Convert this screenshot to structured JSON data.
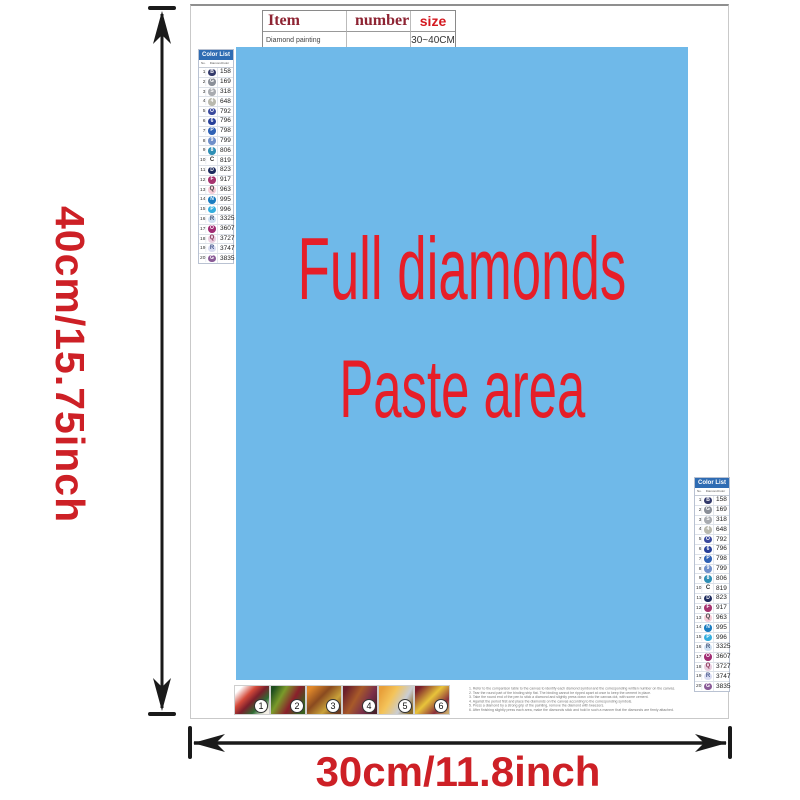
{
  "item_table": {
    "headers": [
      "Item",
      "number",
      "size"
    ],
    "row": [
      "Diamond painting",
      "",
      "30~40CM"
    ]
  },
  "paste_area": {
    "line1": "Full diamonds",
    "line2": "Paste area",
    "bg_color": "#6fb9e9",
    "text_color": "#e61e28"
  },
  "color_list": {
    "title": "Color List",
    "columns": [
      "No.",
      "Diamond",
      "Color"
    ],
    "rows": [
      {
        "no": "1",
        "type": "circle",
        "glyph": "B",
        "bg": "#333a6b",
        "fg": "#ffffff",
        "code": "158"
      },
      {
        "no": "2",
        "type": "circle",
        "glyph": "G",
        "bg": "#8a8f98",
        "fg": "#ffffff",
        "code": "169"
      },
      {
        "no": "3",
        "type": "circle",
        "glyph": "S",
        "bg": "#a8abb0",
        "fg": "#ffffff",
        "code": "318"
      },
      {
        "no": "4",
        "type": "circle",
        "glyph": "4",
        "bg": "#b9b9ae",
        "fg": "#ffffff",
        "code": "648"
      },
      {
        "no": "5",
        "type": "circle",
        "glyph": "O",
        "bg": "#3a4a9e",
        "fg": "#ffffff",
        "code": "792"
      },
      {
        "no": "6",
        "type": "circle",
        "glyph": "6",
        "bg": "#27409a",
        "fg": "#ffffff",
        "code": "796"
      },
      {
        "no": "7",
        "type": "circle",
        "glyph": "P",
        "bg": "#2f62b5",
        "fg": "#ffffff",
        "code": "798"
      },
      {
        "no": "8",
        "type": "circle",
        "glyph": "9",
        "bg": "#6e8fca",
        "fg": "#ffffff",
        "code": "799"
      },
      {
        "no": "9",
        "type": "circle",
        "glyph": "8",
        "bg": "#2e8fb5",
        "fg": "#ffffff",
        "code": "806"
      },
      {
        "no": "10",
        "type": "letter",
        "glyph": "C",
        "bg": "transparent",
        "fg": "#333333",
        "code": "819"
      },
      {
        "no": "11",
        "type": "circle",
        "glyph": "D",
        "bg": "#1d2b5e",
        "fg": "#ffffff",
        "code": "823"
      },
      {
        "no": "12",
        "type": "circle",
        "glyph": "F",
        "bg": "#a6336f",
        "fg": "#ffffff",
        "code": "917"
      },
      {
        "no": "13",
        "type": "letter",
        "glyph": "Q",
        "bg": "#f6cdd8",
        "fg": "#444444",
        "code": "963"
      },
      {
        "no": "14",
        "type": "circle",
        "glyph": "N",
        "bg": "#1a7cc0",
        "fg": "#ffffff",
        "code": "995"
      },
      {
        "no": "15",
        "type": "circle",
        "glyph": "P",
        "bg": "#35aede",
        "fg": "#ffffff",
        "code": "996"
      },
      {
        "no": "16",
        "type": "letter",
        "glyph": "R",
        "bg": "#cfe0f2",
        "fg": "#445577",
        "code": "3325"
      },
      {
        "no": "17",
        "type": "circle",
        "glyph": "O",
        "bg": "#a12d74",
        "fg": "#ffffff",
        "code": "3607"
      },
      {
        "no": "18",
        "type": "letter",
        "glyph": "Q",
        "bg": "#e9cfe0",
        "fg": "#883355",
        "code": "3727"
      },
      {
        "no": "19",
        "type": "letter",
        "glyph": "R",
        "bg": "#d9dcf2",
        "fg": "#445588",
        "code": "3747"
      },
      {
        "no": "20",
        "type": "circle",
        "glyph": "G",
        "bg": "#8a5b97",
        "fg": "#ffffff",
        "code": "3835"
      }
    ]
  },
  "dimensions": {
    "height_label": "40cm/15.75inch",
    "width_label": "30cm/11.8inch",
    "label_color": "#cd2026",
    "arrow_color": "#1a1a1a"
  },
  "steps": {
    "items": [
      {
        "n": "1",
        "bg": "linear-gradient(135deg,#ffffff 12%,#d44a3a 35%,#7a1f2b 52%,#2e6b33 72%,#f4f0e6 92%)"
      },
      {
        "n": "2",
        "bg": "linear-gradient(120deg,#1e4d1e 8%,#7a9a2a 32%,#8a1f2b 60%,#3a5f1f 86%)"
      },
      {
        "n": "3",
        "bg": "linear-gradient(135deg,#e0882a 10%,#8a4a1f 40%,#c9a23a 68%,#6b3a1f 92%)"
      },
      {
        "n": "4",
        "bg": "linear-gradient(120deg,#6b1f2b 10%,#a85a2a 40%,#7a2f4a 68%,#4a1f2b 92%)"
      },
      {
        "n": "5",
        "bg": "linear-gradient(120deg,#e8a03a 10%,#f4c45a 38%,#c9cdd4 68%,#8a6b2a 92%)"
      },
      {
        "n": "6",
        "bg": "linear-gradient(135deg,#7a1f2b 10%,#e8c43a 45%,#8a2f3a 75%,#c9a86b 95%)"
      }
    ]
  },
  "instructions": {
    "lines": [
      {
        "t": "1. Refer to the comparison table to the canvas to identify each diamond symbol and the corresponding written number on the canvas."
      },
      {
        "t": "2. Tear the round part of the binding strip flat. The binding cannot be ripped apart at once to keep the cement in place."
      },
      {
        "t": "3. Take the round end of the pen to stick a diamond and slightly press down onto the canvas dot, with some cement."
      },
      {
        "t": "4. Against the period first and place the diamonds on the canvas according to the corresponding symbols."
      },
      {
        "t": "5. Press a diamond by a strong grip of the painting, remove the diamond with tweezers."
      },
      {
        "t": "6. After finishing slightly press each area, make the diamonds stick and hold in such a manner that the diamonds are firmly attached."
      }
    ]
  }
}
